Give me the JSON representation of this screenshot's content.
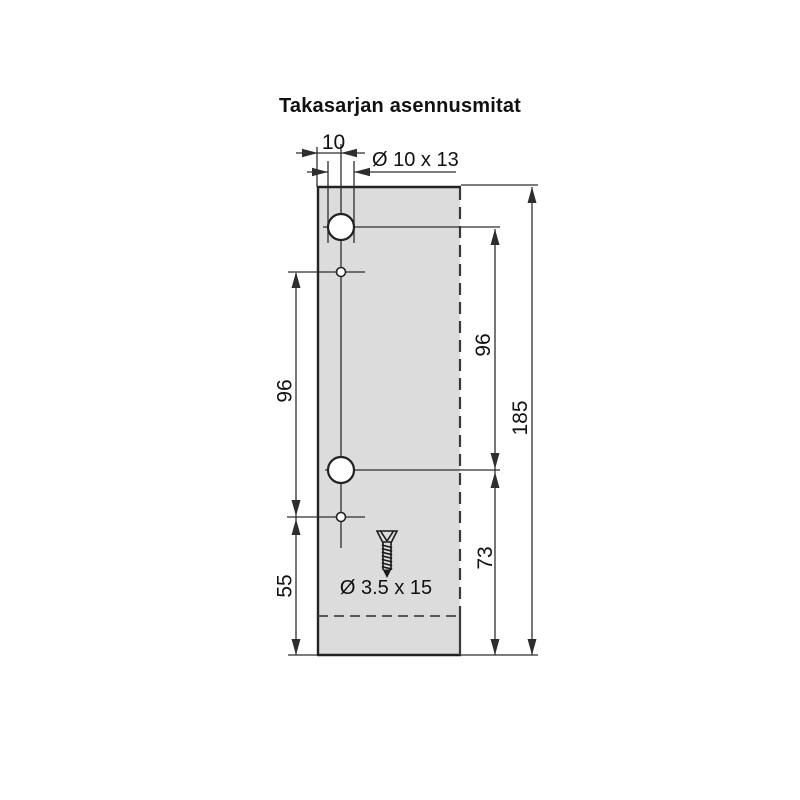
{
  "title": "Takasarjan asennusmitat",
  "labels": {
    "edge_offset": "10",
    "hole_spec": "Ø 10 x 13",
    "left_hole_spacing": "96",
    "right_hole_spacing": "96",
    "total_height": "185",
    "lower_hole_to_bottom": "73",
    "lower_pilot_to_bottom": "55",
    "screw_spec": "Ø 3.5 x 15"
  },
  "dimensions_mm": {
    "edge_to_hole_center": 10,
    "hole_spacing_left": 96,
    "hole_spacing_right": 96,
    "total_height": 185,
    "lower_hole_to_bottom": 73,
    "lower_pilot_to_bottom": 55,
    "large_hole": "Ø 10 x 13",
    "screw": "Ø 3.5 x 15"
  },
  "colors": {
    "background": "#ffffff",
    "panel_fill": "#dcdcdc",
    "line": "#2e2e2e",
    "text": "#111111"
  }
}
